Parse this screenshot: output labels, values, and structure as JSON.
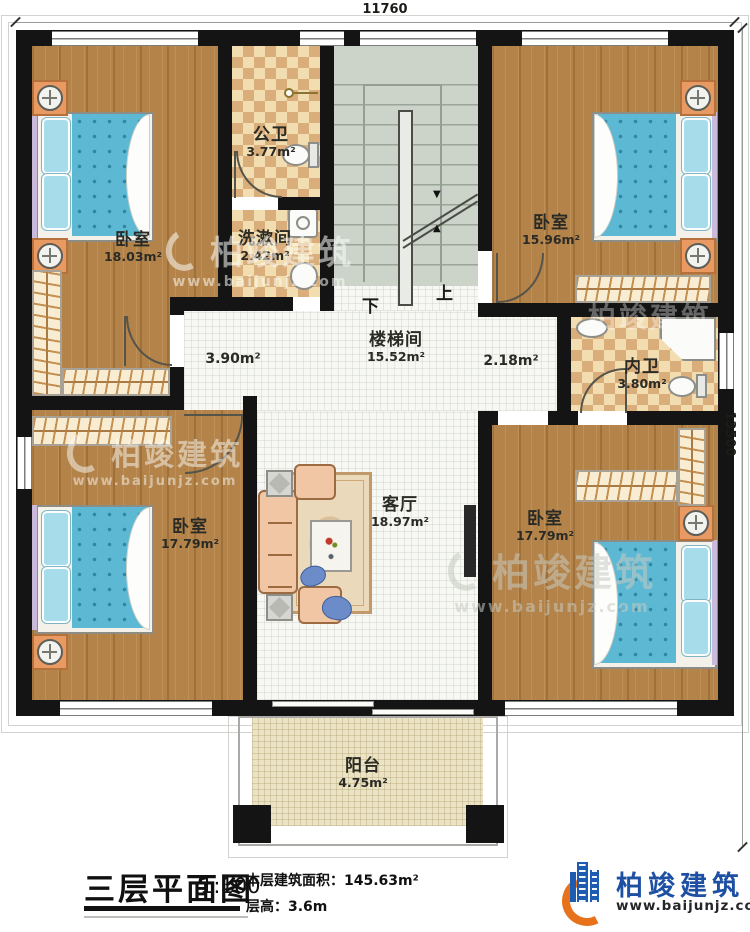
{
  "dimensions": {
    "top": "11760",
    "right": "13500"
  },
  "rooms": {
    "bedroom_tl": {
      "name": "卧室",
      "area": "18.03m²"
    },
    "bath_public": {
      "name": "公卫",
      "area": "3.77m²"
    },
    "washroom": {
      "name": "洗漱间",
      "area": "2.42m²"
    },
    "stairwell": {
      "name": "楼梯间",
      "area": "15.52m²"
    },
    "bedroom_tr": {
      "name": "卧室",
      "area": "15.96m²"
    },
    "bath_inner": {
      "name": "内卫",
      "area": "3.80m²"
    },
    "hall_left": {
      "area": "3.90m²"
    },
    "hall_right": {
      "area": "2.18m²"
    },
    "bedroom_bl": {
      "name": "卧室",
      "area": "17.79m²"
    },
    "living": {
      "name": "客厅",
      "area": "18.97m²"
    },
    "bedroom_br": {
      "name": "卧室",
      "area": "17.79m²"
    },
    "balcony": {
      "name": "阳台",
      "area": "4.75m²"
    }
  },
  "stairs": {
    "down": "下",
    "up": "上"
  },
  "titleblock": {
    "title": "三层平面图",
    "scale": "1:100",
    "area_label": "本层建筑面积：",
    "area_value": "145.63m²",
    "floor_height_label": "层高：",
    "floor_height_value": "3.6m"
  },
  "brand": {
    "name": "柏竣建筑",
    "url": "www.baijunjz.com"
  },
  "colors": {
    "brand_blue": "#1d50a2",
    "brand_orange": "#e8721c",
    "wall": "#141414"
  }
}
